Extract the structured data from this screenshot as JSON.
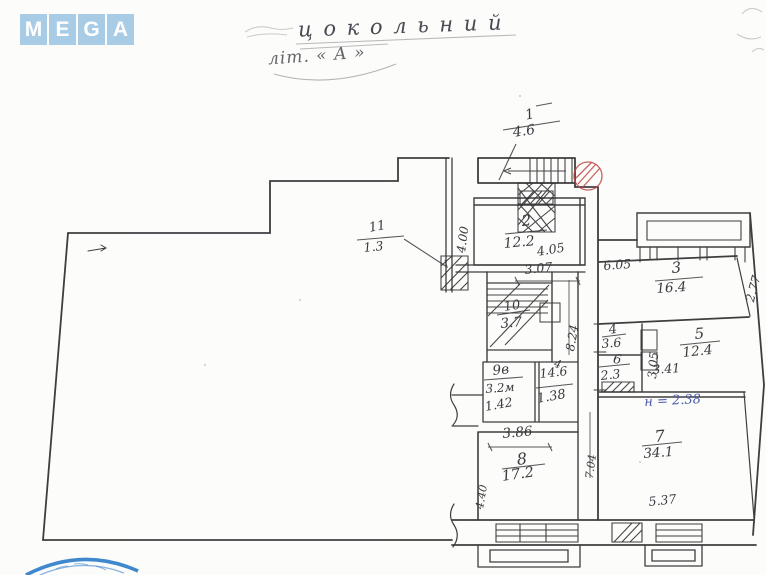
{
  "logo": {
    "letters": [
      "M",
      "E",
      "G",
      "A"
    ]
  },
  "header": {
    "title_line1": "ц о к о л ь н и й",
    "title_line2": "літ. « А »"
  },
  "plan": {
    "rooms": [
      {
        "number": "1",
        "area": "4.6"
      },
      {
        "number": "2",
        "area": "12.2"
      },
      {
        "number": "3",
        "area": "16.4"
      },
      {
        "number": "4",
        "area": "3.6"
      },
      {
        "number": "5",
        "area": "12.4"
      },
      {
        "number": "6",
        "area": "2.3"
      },
      {
        "number": "7",
        "area": "34.1"
      },
      {
        "number": "8",
        "area": "17.2"
      },
      {
        "number": "9в",
        "area": "3.2м"
      },
      {
        "number": "10",
        "area": "3.7"
      },
      {
        "number": "11",
        "area": "1.3"
      }
    ],
    "dimensions": {
      "room2_width": "4.00",
      "room2_diag": "4.05",
      "room2_bottom": "3.07",
      "room3_top": "6.05",
      "room3_right": "2.77",
      "room5_left": "3.05",
      "room5_bottom": "3.41",
      "corridor_height": "8.24",
      "room8_top": "3.86",
      "room9_bottom": "1.42",
      "wc_bottom": "1.38",
      "wc_area": "14.6",
      "room8_left": "4.40",
      "room7_left": "7.04",
      "room7_bottom": "5.37",
      "tick": "4"
    },
    "notes": {
      "height_note": "н = 2.38"
    }
  },
  "colors": {
    "logo_bg": "#a9cce6",
    "ink": "#3a3a40",
    "red_mark": "#c04545",
    "blue_note": "#4a58a8",
    "stamp_blue": "#2b7bc9"
  }
}
